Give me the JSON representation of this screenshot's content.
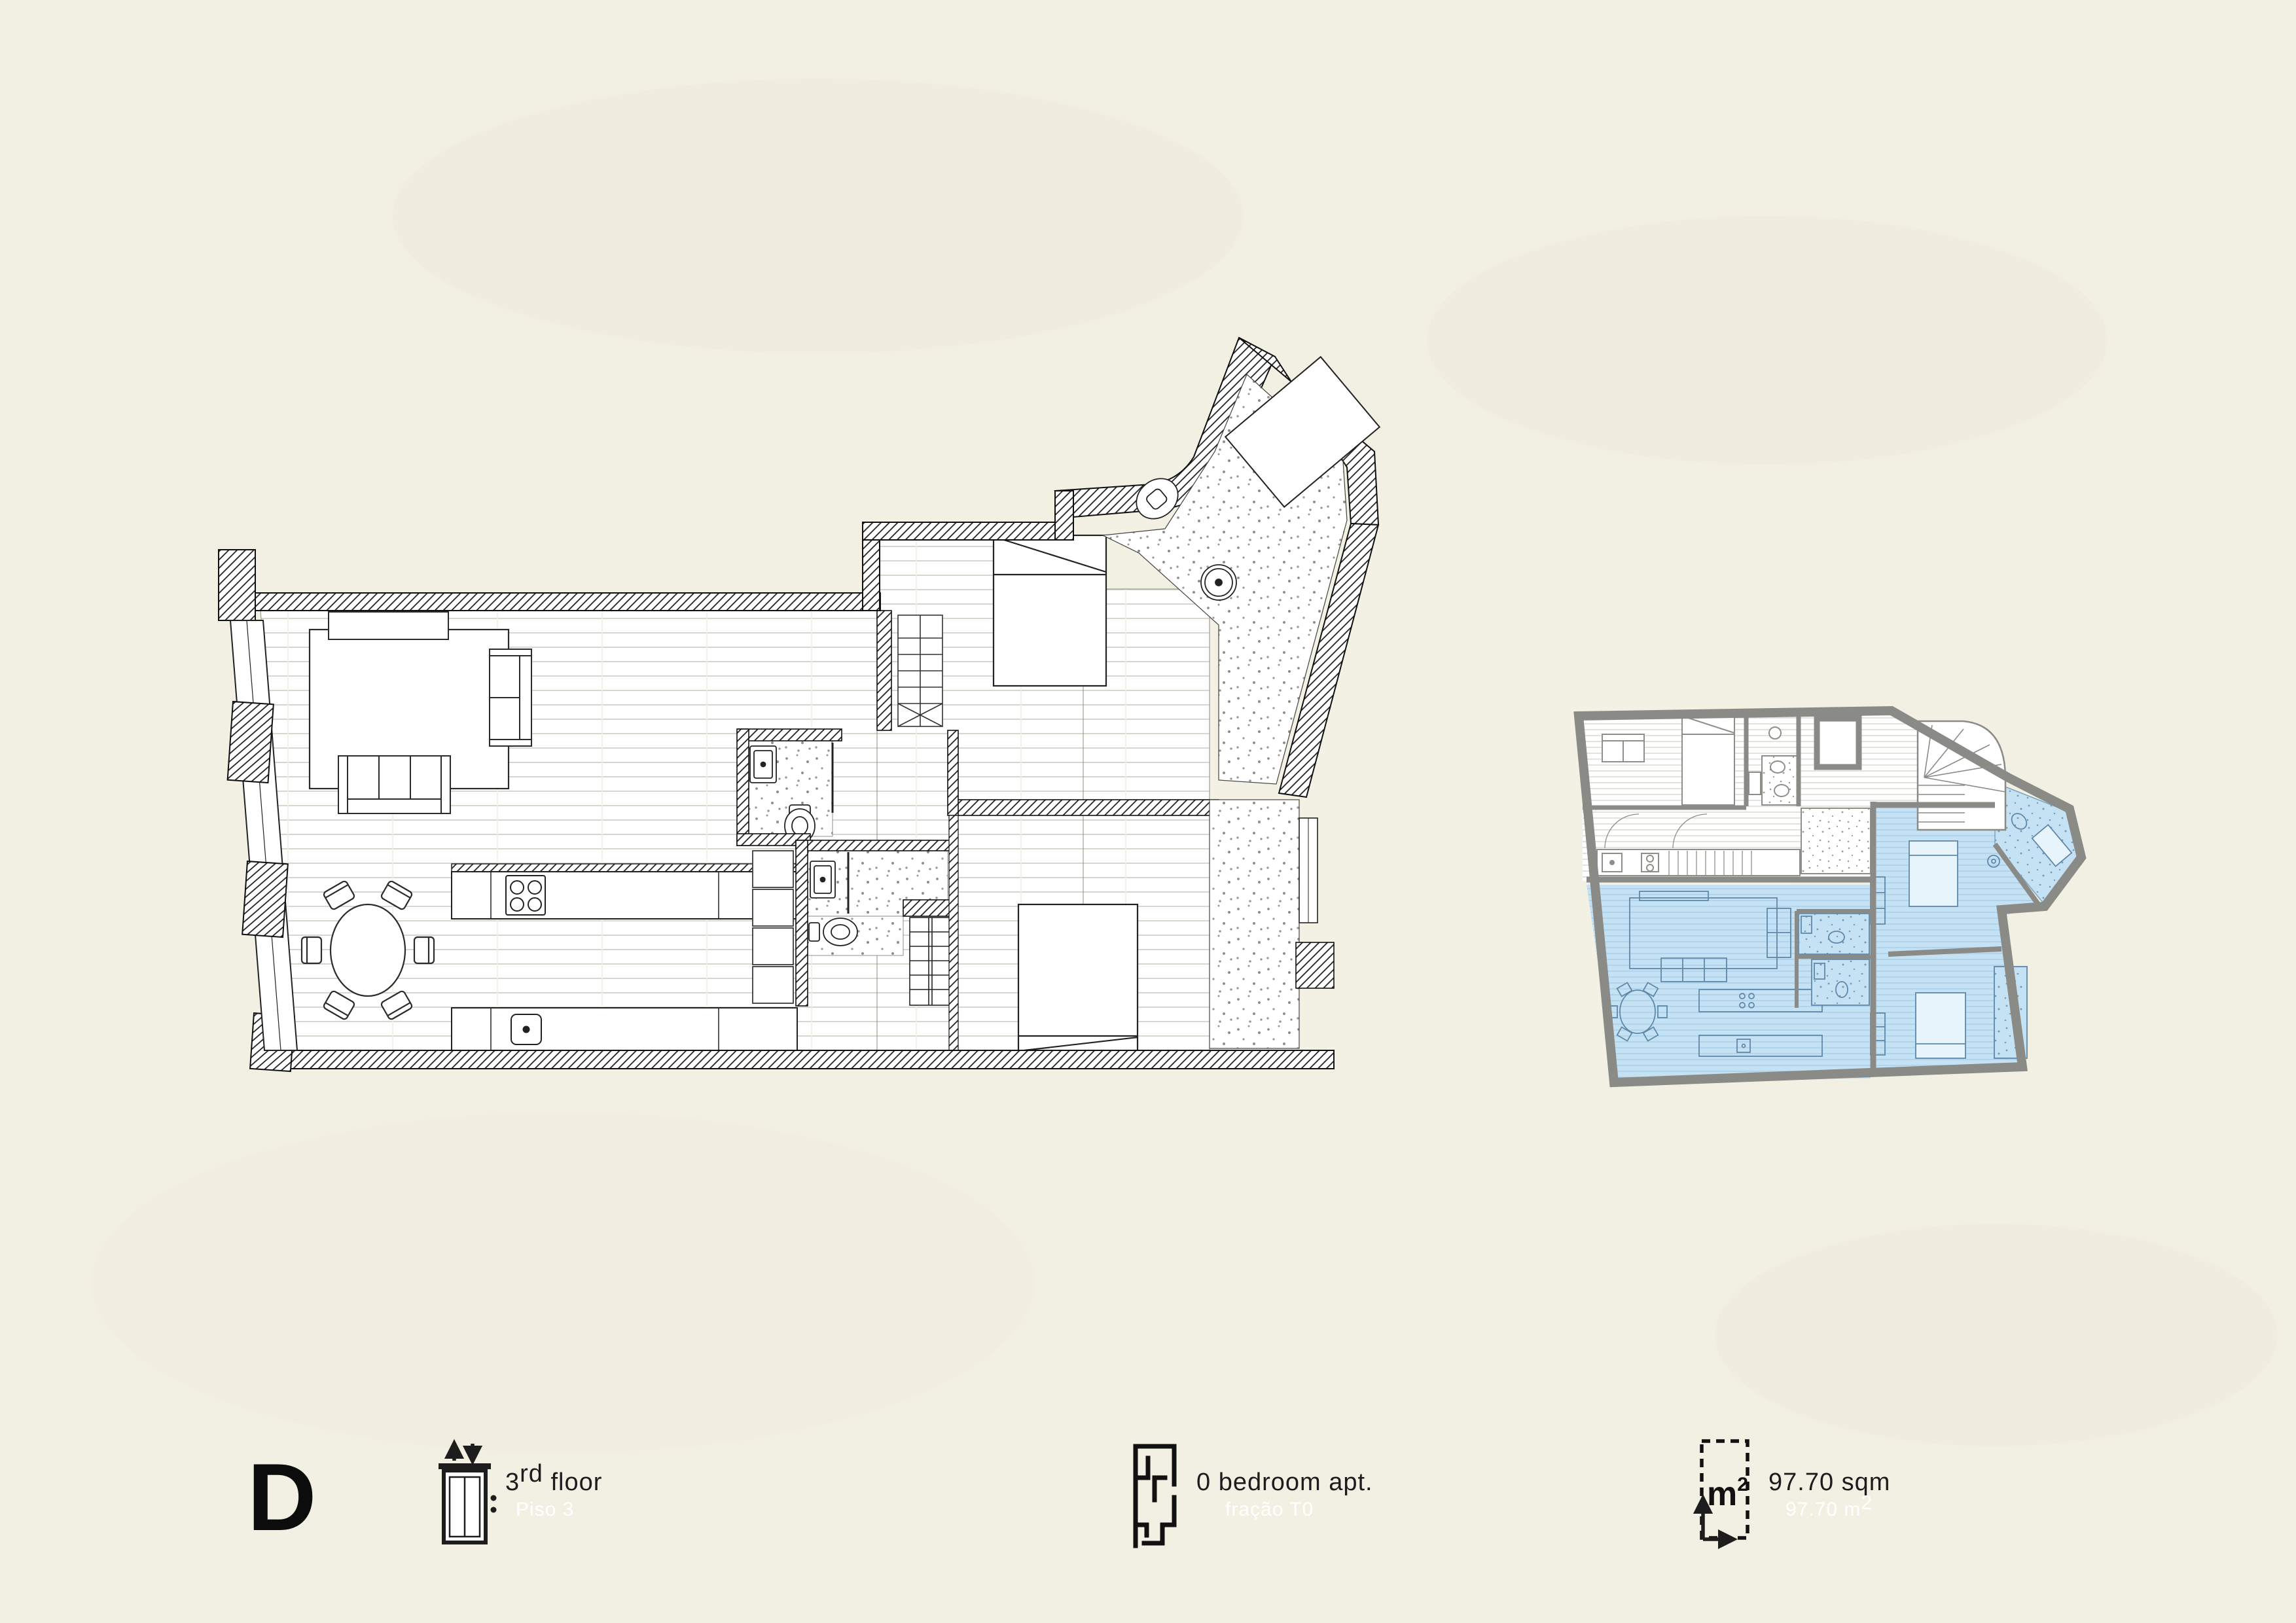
{
  "unit": {
    "letter": "D"
  },
  "legend": {
    "floor": {
      "icon": "elevator-icon",
      "num": "3",
      "suffix": "rd",
      "word": " floor",
      "alt": "Piso 3"
    },
    "type": {
      "icon": "floorplan-icon",
      "label": "0 bedroom apt.",
      "alt": "fração T0"
    },
    "area": {
      "icon": "area-icon",
      "icon_unit": "m",
      "icon_sup": "2",
      "label": "97.70 sqm",
      "alt_main": "97.70 m",
      "alt_sup": "2"
    }
  },
  "colors": {
    "background": "#f2efe3",
    "ink": "#1a1a1a",
    "key-wall": "#8a8a86",
    "highlight-blue": "#c5e2f5",
    "highlight-blue-line": "#a9cfe8",
    "furniture-blue": "#5f88a8"
  }
}
